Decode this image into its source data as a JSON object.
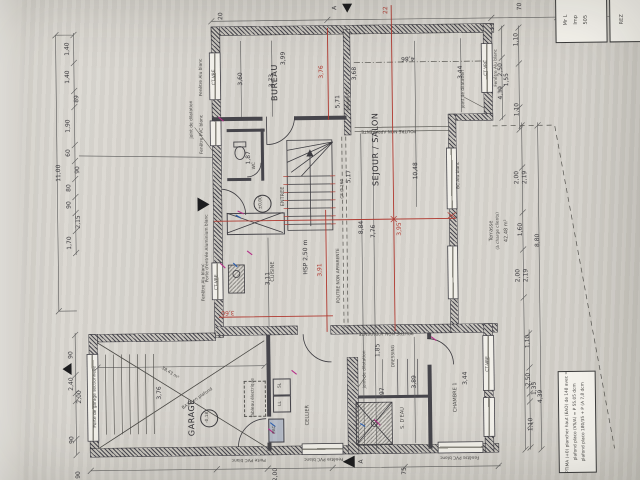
{
  "title_block": {
    "line1": "Mr L",
    "line2": "Imp",
    "line3": "505",
    "sheet": "REZ"
  },
  "note_box": {
    "line1": "Rdc OPTIMA (+0) plancher haut (EAO) de 148 avec = BA13",
    "line2": "plafond placo (VS/A) = P 55.05 dcm",
    "line3": "plafond placo 180/35 + P (A 7,8 dcm"
  },
  "section_marks": {
    "top": "A",
    "bottom": "A"
  },
  "rooms": {
    "bureau": "BUREAU",
    "sejour": "SEJOUR / SALON",
    "entree": "ENTREE",
    "wc": "WC",
    "cuisine": "CUISINE",
    "garage": "GARAGE",
    "cellier": "CELLIER",
    "sdeau": "S. D'EAU",
    "dressing": "DRESSING",
    "chambre": "CHAMBRE 1",
    "terrasse": "Terrasse",
    "terrasse_sub": "(à charge clients)",
    "terrasse_area": "42,48 m²"
  },
  "levels": {
    "entree": "±0,00",
    "garage": "-0,18"
  },
  "labels": {
    "hsp": "HSP 2,50 m",
    "poutre": "POUTRE NON APPARENTE",
    "cf160": "CF Ø 160",
    "cloison_cf": "cloison CF",
    "joint": "joint de dilatation",
    "porte_garage": "Porte de garage sectionnelle",
    "porte_entree": "Porte d'entrée Aluminium blanc",
    "fen_alu": "Fenêtre Alu blanc",
    "fen_pvc": "Fenêtre PVC blanc",
    "porte_pvc": "Porte PVC blanc",
    "ct_vre": "CT VRE",
    "bc_alu": "BC Alu blanc",
    "pac": "PAC",
    "ll": "LL",
    "sl": "SL",
    "tableau": "Tableau électrique",
    "garage_m2": "38,43 m²",
    "garage_plafond": "BA13 en plafond"
  },
  "dims": {
    "left_total": "11,00",
    "left_chain": [
      "1,40",
      "1,40",
      "89",
      "1,90",
      "60",
      "90",
      "80",
      "90",
      "2,15",
      "1,70"
    ],
    "left_lower": [
      "90",
      "2,40",
      "2,00",
      "90"
    ],
    "top_chain": [
      "20"
    ],
    "right_upper": [
      "70",
      "1,10",
      "2,50",
      "1,55",
      "4,39",
      "1,10"
    ],
    "terrace_chain": [
      "2,00",
      "2,19",
      "1,60",
      "2,00",
      "2,19"
    ],
    "terrace_total": "8,80",
    "right_lower": [
      "1,10",
      "2,50",
      "1,35",
      "4,39",
      "1,10"
    ],
    "bottom_chain": [
      "90",
      "2,00",
      "75"
    ],
    "bureau": [
      "3,60",
      "3,73",
      "3,99"
    ],
    "sejour": [
      "5,71",
      "3,68",
      "10,48",
      "5,17",
      "8,84",
      "7,76",
      "4,86",
      "3,44"
    ],
    "cuisine": [
      "3,11",
      "1,87"
    ],
    "garage": [
      "3,76"
    ],
    "sdeau": [
      "1,85",
      "97"
    ],
    "chambre": [
      "3,89",
      "3,44"
    ]
  },
  "red_dims": {
    "top": "22",
    "bureau": "3,76",
    "cuisine": "3,60",
    "hall": "3,91",
    "sejour": "3,95"
  },
  "colors": {
    "paper": "#d8d5cf",
    "ink": "#3a3a3e",
    "red": "#b03a31",
    "magenta": "#b52f88",
    "blue": "#2b5fb0"
  }
}
